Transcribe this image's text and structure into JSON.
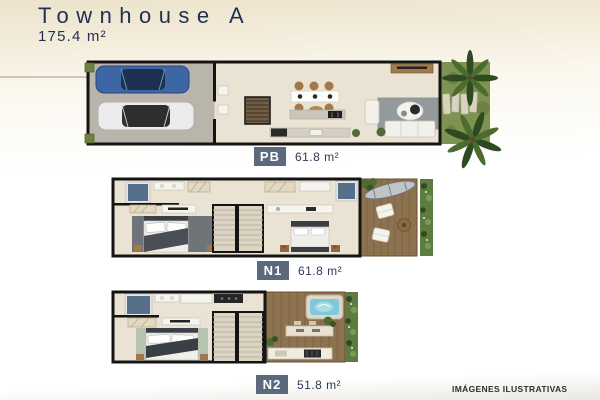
{
  "header": {
    "title": "Townhouse A",
    "total_area": "175.4 m²"
  },
  "floors": [
    {
      "label": "PB",
      "area": "61.8 m²",
      "depicts": "garage with two cars, stairs, kitchen, dining, living room, garden with palm trees"
    },
    {
      "label": "N1",
      "area": "61.8 m²",
      "depicts": "two bedrooms with bathrooms, central stairs, wood-deck terrace with hammock and lounge cushions"
    },
    {
      "label": "N2",
      "area": "51.8 m²",
      "depicts": "bedroom with bathroom, stairs, roof terrace with jacuzzi, bar and outdoor kitchen"
    }
  ],
  "footer": {
    "disclaimer": "IMÁGENES ILUSTRATIVAS"
  },
  "colors": {
    "title_text": "#223150",
    "badge_bg": "#5a6a7c",
    "badge_text": "#ffffff",
    "page_top": "#ece3cc",
    "wall": "#141414",
    "floor": "#eae2d2",
    "garage_floor": "#b9b5ab",
    "grass": "#7e9252",
    "deck": "#8d7250",
    "hedge": "#5f7c40",
    "water": "#7fc9da",
    "car_blue": "#3d66a5",
    "rug_gray": "#94999c"
  }
}
